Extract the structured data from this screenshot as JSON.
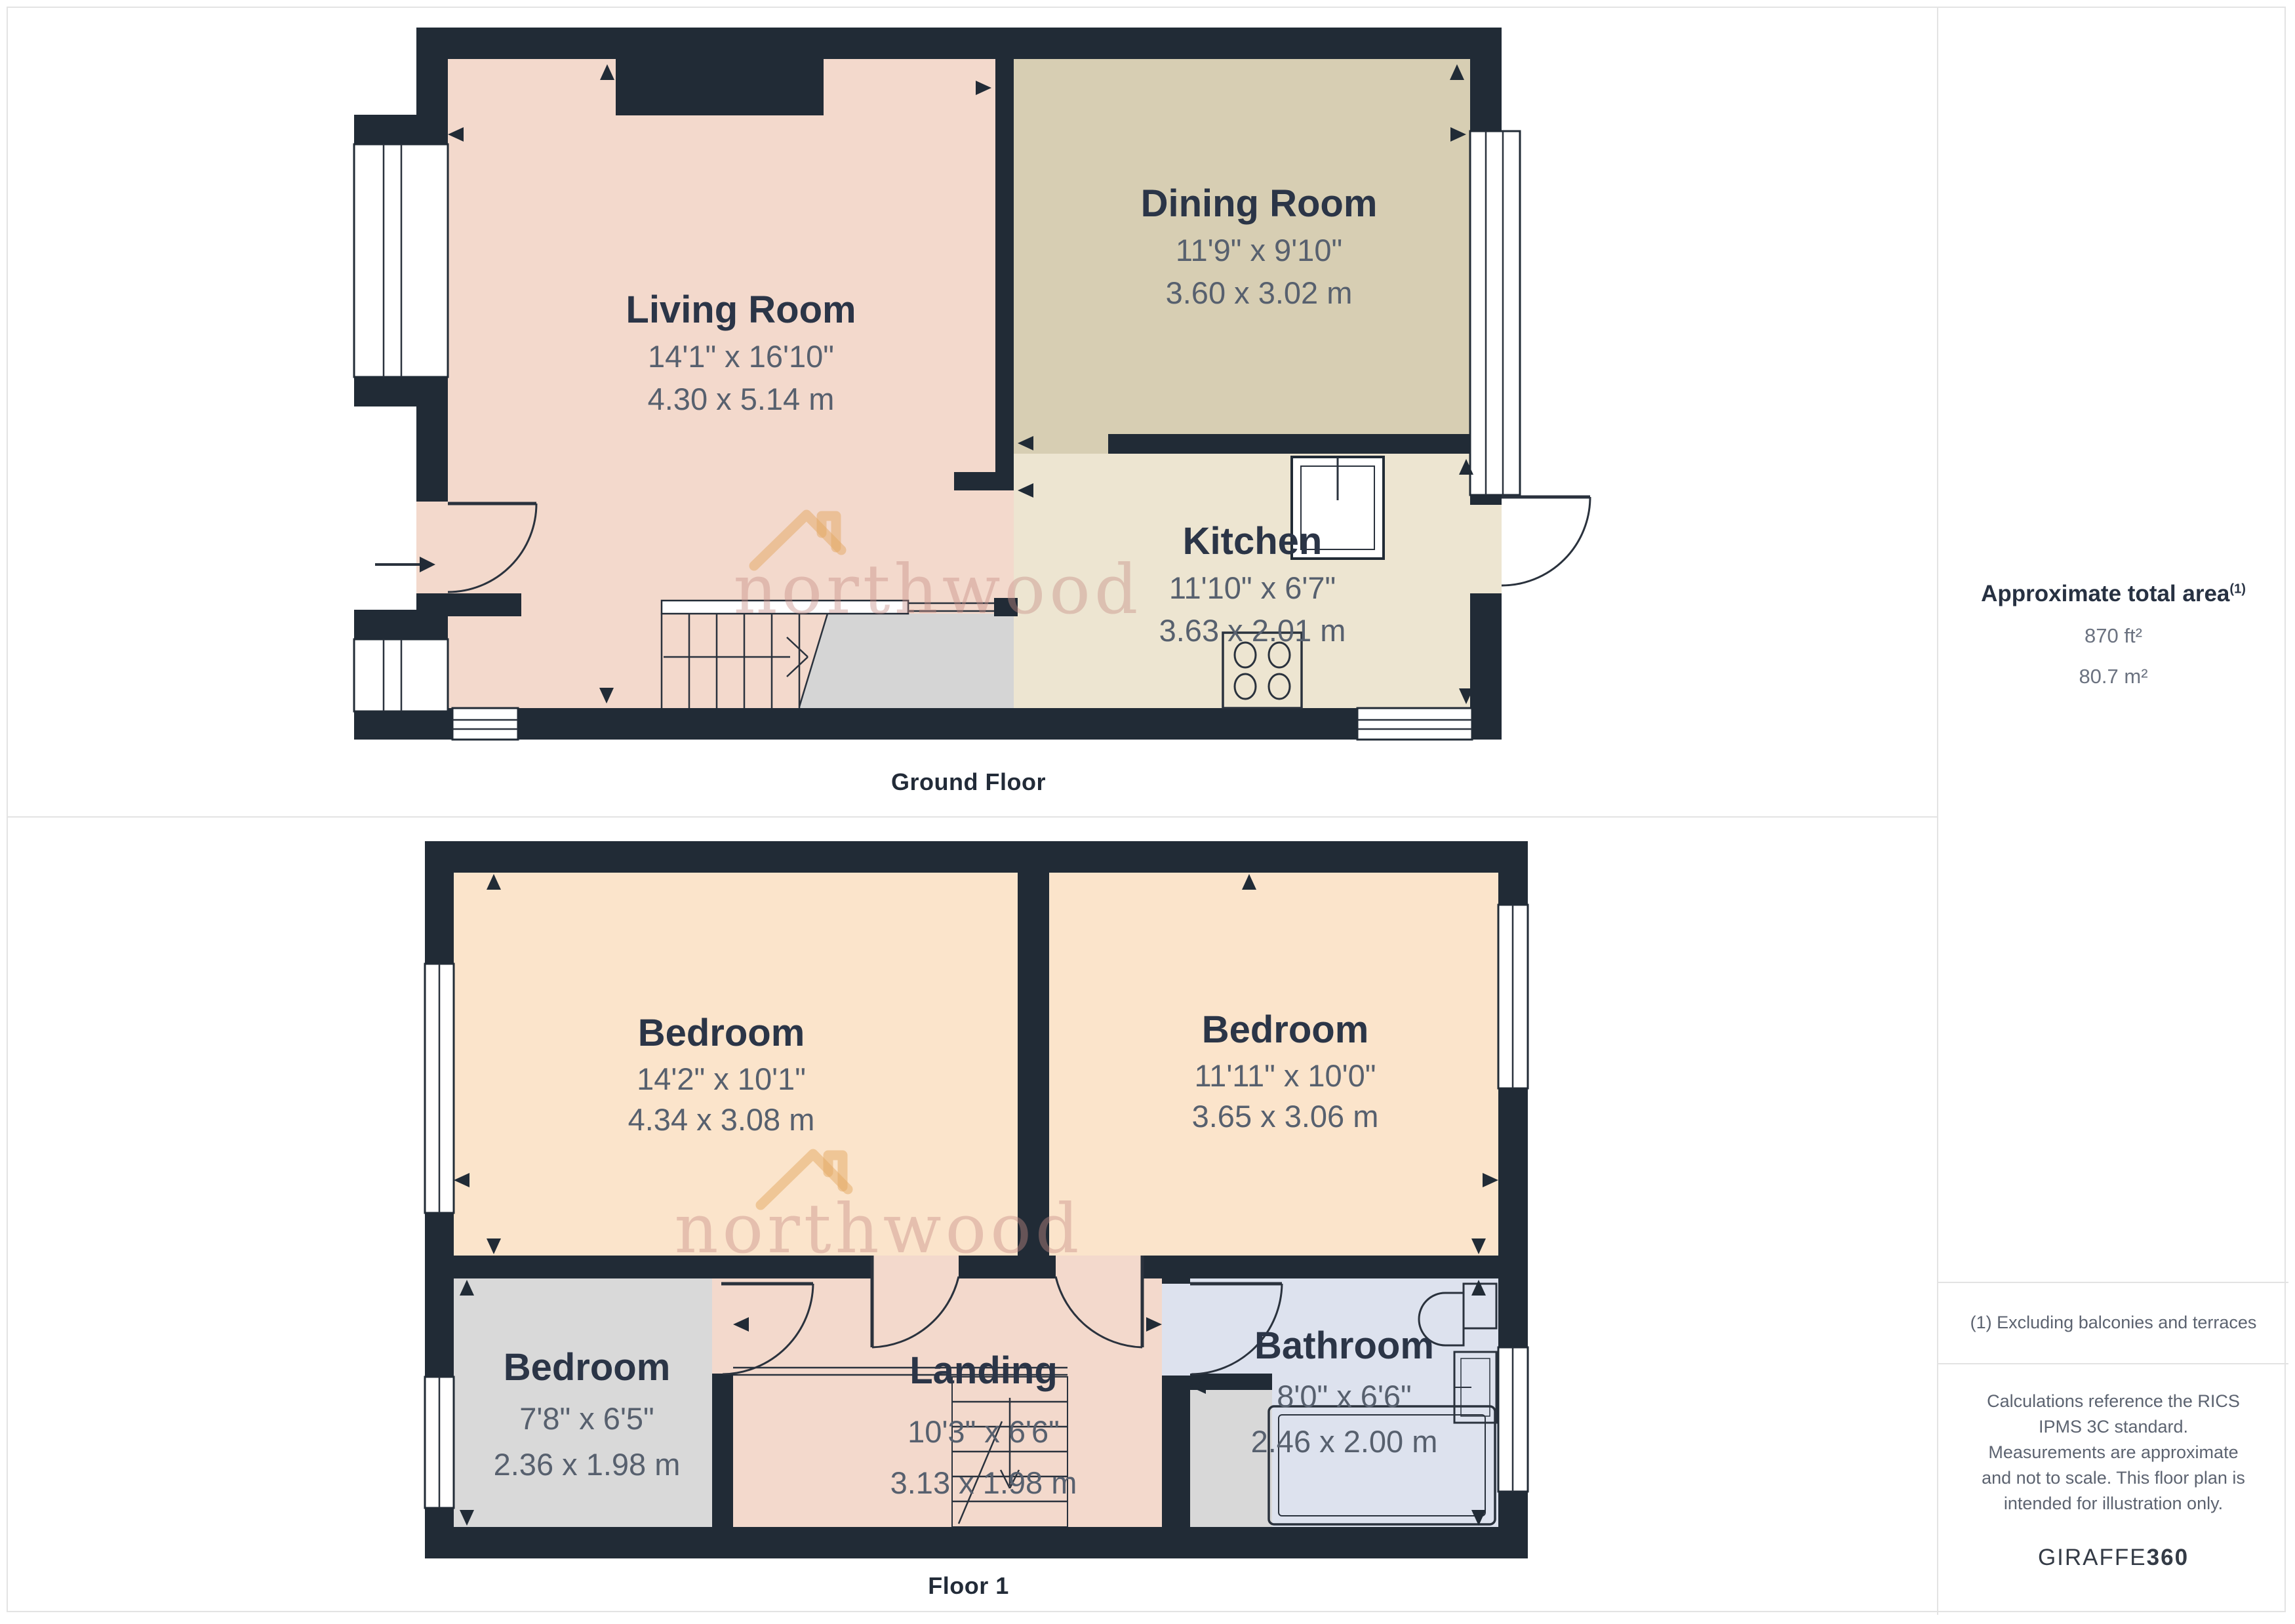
{
  "branding": {
    "watermark_text": "northwood",
    "giraffe_brand": "GIRAFFE",
    "giraffe_suffix": "360"
  },
  "sidebar": {
    "area_title": "Approximate total area",
    "area_superscript": "(1)",
    "area_imperial": "870 ft²",
    "area_metric": "80.7 m²",
    "footnote": "(1) Excluding balconies and terraces",
    "disclaimer": "Calculations reference the RICS IPMS 3C standard. Measurements are approximate and not to scale. This floor plan is intended for illustration only."
  },
  "floors": [
    {
      "caption": "Ground Floor",
      "rooms": [
        {
          "name": "Living Room",
          "imperial": "14'1\" x 16'10\"",
          "metric": "4.30 x 5.14 m"
        },
        {
          "name": "Dining Room",
          "imperial": "11'9\" x 9'10\"",
          "metric": "3.60 x 3.02 m"
        },
        {
          "name": "Kitchen",
          "imperial": "11'10\" x 6'7\"",
          "metric": "3.63 x 2.01 m"
        }
      ]
    },
    {
      "caption": "Floor 1",
      "rooms": [
        {
          "name": "Bedroom",
          "imperial": "14'2\" x 10'1\"",
          "metric": "4.34 x 3.08 m"
        },
        {
          "name": "Bedroom",
          "imperial": "11'11\" x 10'0\"",
          "metric": "3.65 x 3.06 m"
        },
        {
          "name": "Bedroom",
          "imperial": "7'8\" x 6'5\"",
          "metric": "2.36 x 1.98 m"
        },
        {
          "name": "Landing",
          "imperial": "10'3\" x 6'6\"",
          "metric": "3.13 x 1.98 m"
        },
        {
          "name": "Bathroom",
          "imperial": "8'0\" x 6'6\"",
          "metric": "2.46 x 2.00 m"
        }
      ]
    }
  ],
  "colors": {
    "wall": "#212b36",
    "living_room": "#f3d9cc",
    "dining_room": "#d7ceb3",
    "kitchen": "#ede5d1",
    "bedroom": "#fbe4cb",
    "bedroom_small": "#d9d9d9",
    "bathroom": "#dde2ee",
    "stairs_gray": "#d5d5d5",
    "panel_border": "#e3e3e3",
    "room_title_text": "#2b3547",
    "room_dims_text": "#57606e"
  }
}
